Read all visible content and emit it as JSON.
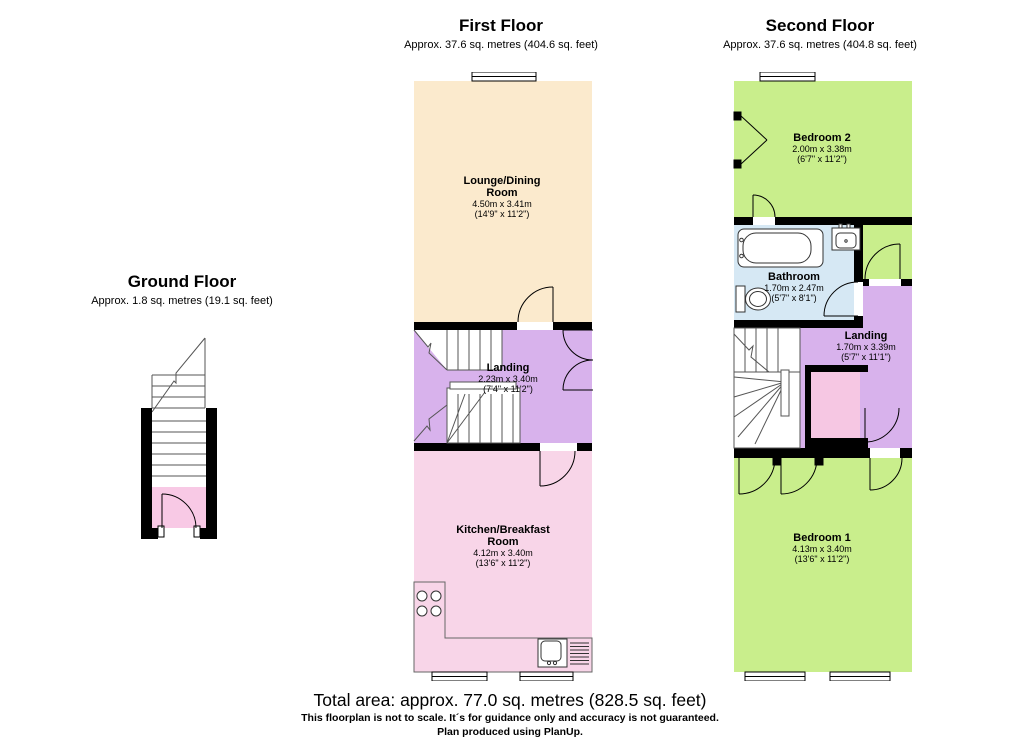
{
  "floors": {
    "ground": {
      "title": "Ground Floor",
      "subtitle": "Approx. 1.8 sq. metres (19.1 sq. feet)"
    },
    "first": {
      "title": "First Floor",
      "subtitle": "Approx. 37.6 sq. metres (404.6 sq. feet)"
    },
    "second": {
      "title": "Second Floor",
      "subtitle": "Approx. 37.6 sq. metres (404.8 sq. feet)"
    }
  },
  "rooms": {
    "lounge": {
      "name": "Lounge/Dining Room",
      "metric": "4.50m x 3.41m",
      "imperial": "(14'9\" x 11'2\")"
    },
    "landing_first": {
      "name": "Landing",
      "metric": "2.23m x 3.40m",
      "imperial": "(7'4\" x 11'2\")"
    },
    "kitchen": {
      "name": "Kitchen/Breakfast Room",
      "metric": "4.12m x 3.40m",
      "imperial": "(13'6\" x 11'2\")"
    },
    "bedroom2": {
      "name": "Bedroom 2",
      "metric": "2.00m x 3.38m",
      "imperial": "(6'7\" x 11'2\")"
    },
    "bathroom": {
      "name": "Bathroom",
      "metric": "1.70m x 2.47m",
      "imperial": "(5'7\" x 8'1\")"
    },
    "landing_second": {
      "name": "Landing",
      "metric": "1.70m x 3.39m",
      "imperial": "(5'7\" x 11'1\")"
    },
    "bedroom1": {
      "name": "Bedroom 1",
      "metric": "4.13m x 3.40m",
      "imperial": "(13'6\" x 11'2\")"
    }
  },
  "footer": {
    "total": "Total area: approx. 77.0 sq. metres (828.5 sq. feet)",
    "disclaimer": "This floorplan is not to scale. It´s for guidance only and accuracy is not guaranteed.",
    "credit": "Plan produced using PlanUp."
  },
  "colors": {
    "wall": "#000000",
    "lounge": "#fbeacd",
    "landing": "#d8b2ec",
    "kitchen": "#f8d5e8",
    "hall_pink": "#f8c9e5",
    "bedroom": "#c9ee8c",
    "bathroom": "#d6e8f4",
    "cupboard": "#f6c7e3",
    "fixture_stroke": "#333333",
    "stair_stroke": "#555555"
  }
}
